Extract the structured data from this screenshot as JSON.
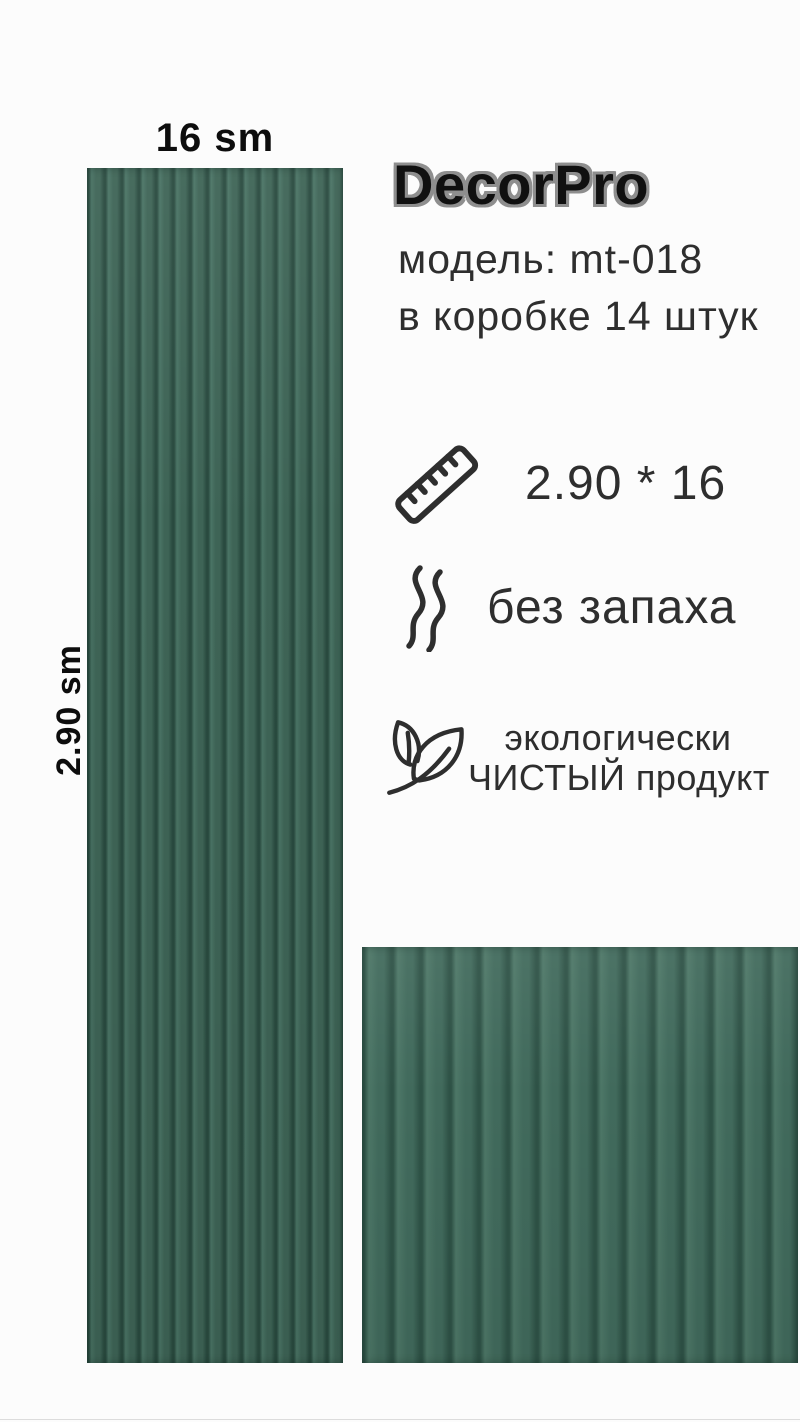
{
  "brand": {
    "logo": "DecorPro"
  },
  "product": {
    "model_line": "модель: mt-018",
    "box_line": "в коробке 14 штук"
  },
  "dimensions": {
    "width_label": "16 sm",
    "height_label": "2.90 sm"
  },
  "features": [
    {
      "icon": "ruler-icon",
      "text": "2.90 * 16"
    },
    {
      "icon": "scent-icon",
      "text": "без запаха"
    },
    {
      "icon": "leaf-icon",
      "text_line1": "экологически",
      "text_line2": "ЧИСТЫЙ продукт"
    }
  ],
  "colors": {
    "background": "#fcfcfc",
    "text": "#2e2e2e",
    "logo_fill": "#101010",
    "logo_outline": "#8e8e8e",
    "panel_base": "#3e6456",
    "panel_groove": "#294a3f",
    "panel_highlight": "#4a7465",
    "closeup_base": "#416a5c"
  }
}
